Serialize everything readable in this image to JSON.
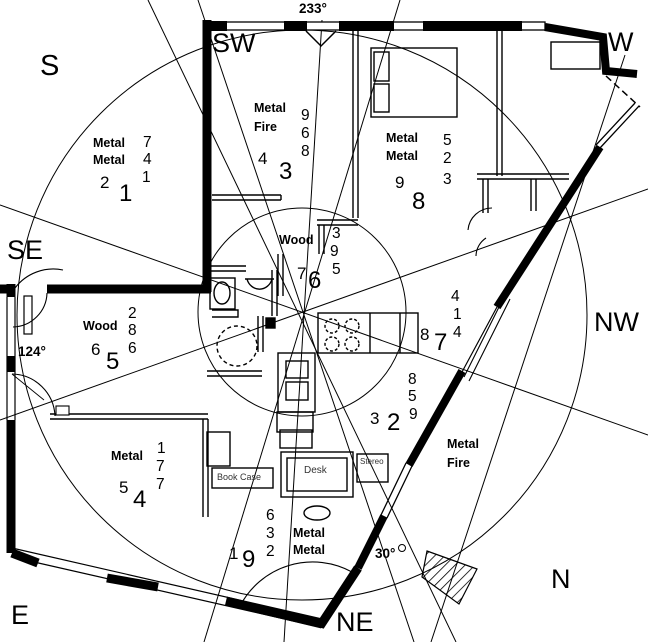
{
  "compass": {
    "s": "S",
    "sw": "SW",
    "w": "W",
    "se": "SE",
    "nw": "NW",
    "e": "E",
    "ne": "NE",
    "n": "N"
  },
  "degrees": {
    "facing": "233°",
    "se_door": "124°",
    "ne_door": "30°"
  },
  "palaces": {
    "s": {
      "elements": [
        "Metal",
        "Metal"
      ],
      "column": [
        "7",
        "4",
        "1"
      ],
      "pair": [
        "2",
        "1"
      ]
    },
    "sw": {
      "elements": [
        "Metal",
        "Fire"
      ],
      "column": [
        "9",
        "6",
        "8"
      ],
      "pair": [
        "4",
        "3"
      ]
    },
    "w": {
      "elements": [
        "Metal",
        "Metal"
      ],
      "column": [
        "5",
        "2",
        "3"
      ],
      "pair": [
        "9",
        "8"
      ]
    },
    "se": {
      "elements": [
        "Wood"
      ],
      "column": [
        "2",
        "8",
        "6"
      ],
      "pair": [
        "6",
        "5"
      ]
    },
    "center": {
      "elements": [
        "Wood"
      ],
      "column": [
        "3",
        "9",
        "5"
      ],
      "pair": [
        "7",
        "6"
      ]
    },
    "nw": {
      "elements": [],
      "column": [
        "4",
        "1",
        "4"
      ],
      "pair": [
        "8",
        "7"
      ]
    },
    "e": {
      "elements": [
        "Metal"
      ],
      "column": [
        "1",
        "7",
        "7"
      ],
      "pair": [
        "5",
        "4"
      ]
    },
    "ne": {
      "elements": [
        "Metal",
        "Metal"
      ],
      "column": [
        "6",
        "3",
        "2"
      ],
      "pair": [
        "1",
        "9"
      ]
    },
    "n": {
      "elements": [
        "Metal",
        "Fire"
      ],
      "column": [
        "8",
        "5",
        "9"
      ],
      "pair": [
        "3",
        "2"
      ]
    }
  },
  "furniture": {
    "bookcase": "Book Case",
    "desk": "Desk",
    "stereo": "Stereo"
  }
}
